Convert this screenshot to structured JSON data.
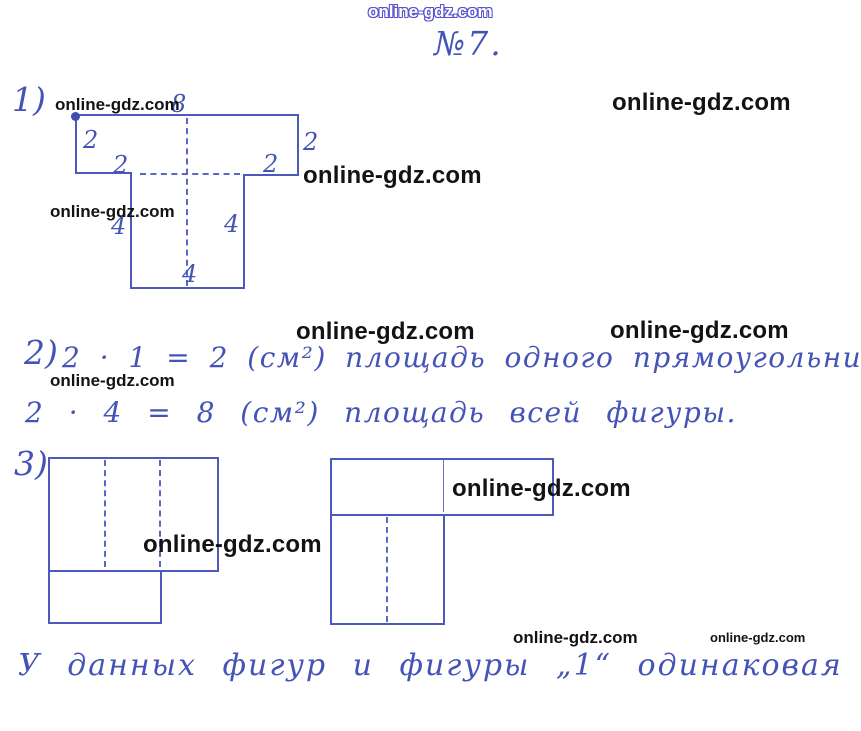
{
  "watermark": {
    "text": "online-gdz.com"
  },
  "title": "№7.",
  "colors": {
    "pen_blue": "#4453b6",
    "figure_line_blue": "#4c5bbb",
    "watermark_black": "#131313",
    "watermark_outline_blue": "#5a52cc"
  },
  "sections": {
    "s1": {
      "num": "1)"
    },
    "s2": {
      "num": "2)",
      "line1": "2 · 1 = 2 (см²) площадь одного прямоугольника.",
      "line2": "2 · 4 = 8 (см²) площадь всей фигуры."
    },
    "s3": {
      "num": "3)"
    }
  },
  "fig1_labels": {
    "top": "8",
    "side_left": "2",
    "inner_left": "2",
    "side_right": "2",
    "inner_right": "2",
    "stem_left": "4",
    "stem_right": "4",
    "stem_bottom": "4"
  },
  "conclusion": "У данных фигур и фигуры „1“ одинаковая площадь."
}
